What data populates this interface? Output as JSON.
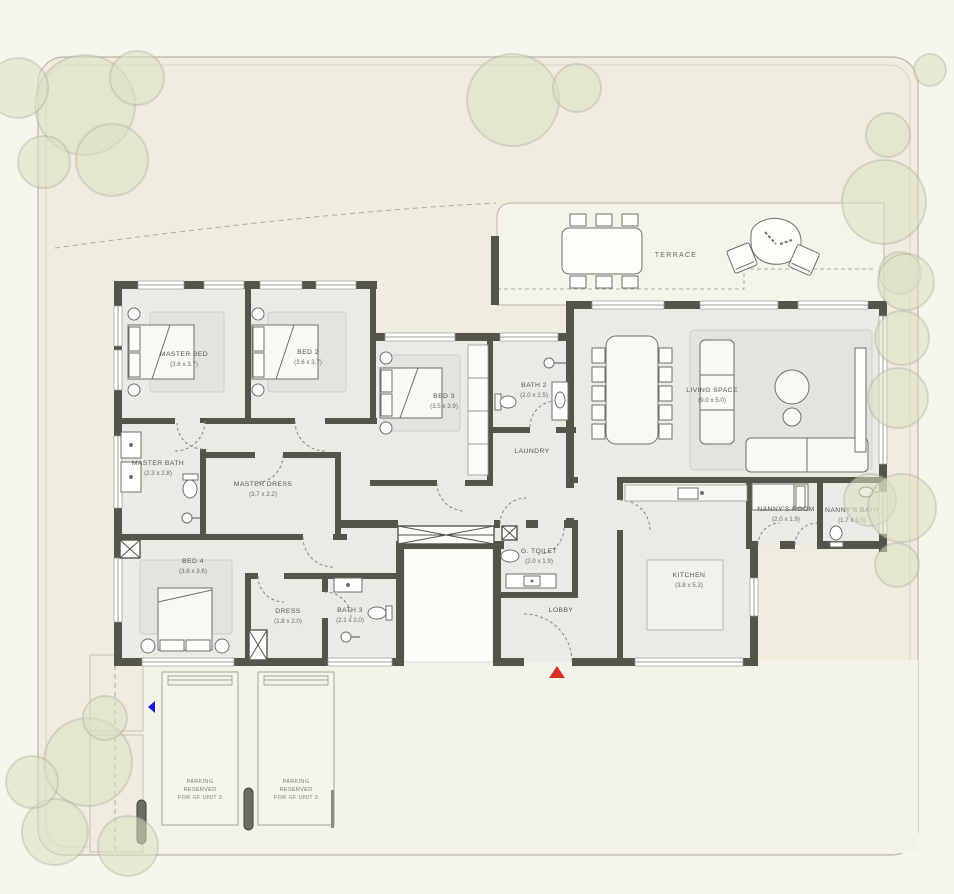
{
  "plan_type": "ground-floor-plan",
  "colors": {
    "wall": "#53554B",
    "floor": "#E9EBE5",
    "site_fill": "#EEEDDE",
    "driveway_fill": "#F4F3E9",
    "tree": "#DDE0C1",
    "entrance_arrow": "#D93025",
    "direction_marker": "#1A1ADF"
  },
  "rooms": [
    {
      "name": "MASTER BED",
      "dims": "(3.6 x 3.7)"
    },
    {
      "name": "BED 2",
      "dims": "(3.6 x 3.7)"
    },
    {
      "name": "BED 3",
      "dims": "(3.5 x 3.9)"
    },
    {
      "name": "BATH 2",
      "dims": "(2.0 x 2.5)"
    },
    {
      "name": "LAUNDRY",
      "dims": ""
    },
    {
      "name": "MASTER BATH",
      "dims": "(2.3 x 2.8)"
    },
    {
      "name": "MASTER DRESS",
      "dims": "(3.7 x 2.2)"
    },
    {
      "name": "BED 4",
      "dims": "(3.8 x 3.6)"
    },
    {
      "name": "DRESS",
      "dims": "(1.8 x 2.0)"
    },
    {
      "name": "BATH 3",
      "dims": "(2.1 x 2.0)"
    },
    {
      "name": "G. TOILET",
      "dims": "(2.0 x 1.9)"
    },
    {
      "name": "LOBBY",
      "dims": ""
    },
    {
      "name": "KITCHEN",
      "dims": "(3.8 x 5.3)"
    },
    {
      "name": "NANNY'S ROOM",
      "dims": "(2.0 x 1.9)"
    },
    {
      "name": "NANNY'S BATH",
      "dims": "(1.7 x 1.5)"
    },
    {
      "name": "LIVING SPACE",
      "dims": "(9.0 x 5.0)"
    }
  ],
  "outdoor": {
    "terrace": "TERRACE"
  },
  "parking": {
    "lines": [
      "PARKING",
      "RESERVED",
      "FOR GF UNIT 3"
    ]
  }
}
